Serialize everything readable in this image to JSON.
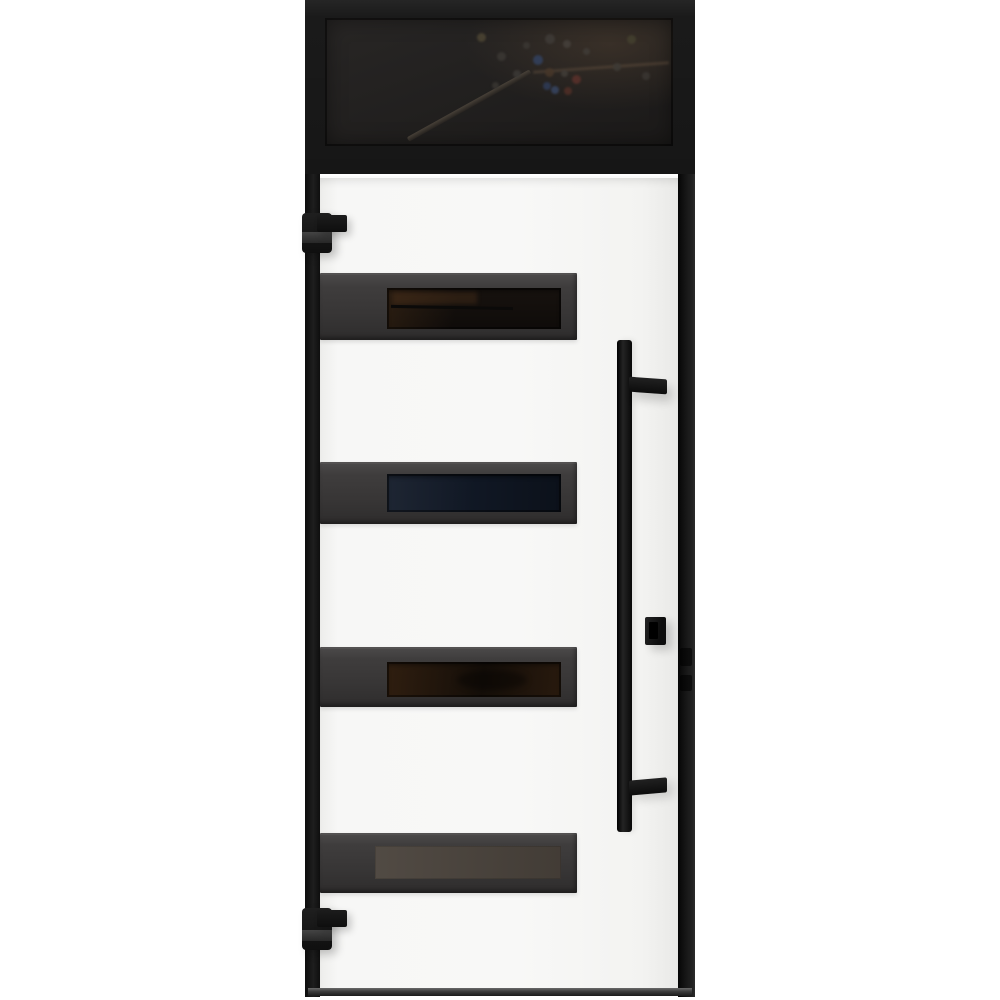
{
  "scene": {
    "subject": "Modern white front entry door with black metal frame, dark transom window above, four horizontal smoked-glass strips, long vertical black pull handle, lock cylinder and two black pivot hinges",
    "background": "#ffffff"
  },
  "palette": {
    "frame_black": "#1a1a1a",
    "door_white": "#f6f6f5",
    "strip_frame_gray": "#3b3939",
    "hardware_black": "#121212",
    "threshold_gray": "#3a3a3a"
  },
  "transom": {
    "glass_base": "#211f1e",
    "reflection_dots": [
      {
        "x": 152,
        "y": 15,
        "s": 9,
        "c": "#4a4332"
      },
      {
        "x": 198,
        "y": 24,
        "s": 7,
        "c": "#3a3632"
      },
      {
        "x": 220,
        "y": 16,
        "s": 10,
        "c": "#3e3a36"
      },
      {
        "x": 238,
        "y": 22,
        "s": 8,
        "c": "#443f3a"
      },
      {
        "x": 258,
        "y": 30,
        "s": 7,
        "c": "#3f3b36"
      },
      {
        "x": 172,
        "y": 34,
        "s": 9,
        "c": "#3a3733"
      },
      {
        "x": 208,
        "y": 37,
        "s": 10,
        "c": "#32405c"
      },
      {
        "x": 188,
        "y": 52,
        "s": 8,
        "c": "#3b3835"
      },
      {
        "x": 220,
        "y": 50,
        "s": 9,
        "c": "#463629"
      },
      {
        "x": 236,
        "y": 52,
        "s": 7,
        "c": "#403c37"
      },
      {
        "x": 247,
        "y": 57,
        "s": 9,
        "c": "#58302a"
      },
      {
        "x": 218,
        "y": 64,
        "s": 8,
        "c": "#2e3a54"
      },
      {
        "x": 226,
        "y": 68,
        "s": 8,
        "c": "#36435e"
      },
      {
        "x": 239,
        "y": 69,
        "s": 8,
        "c": "#4e2e26"
      },
      {
        "x": 167,
        "y": 64,
        "s": 7,
        "c": "#383531"
      },
      {
        "x": 302,
        "y": 17,
        "s": 9,
        "c": "#433f2e"
      },
      {
        "x": 288,
        "y": 45,
        "s": 8,
        "c": "#3d3a35"
      },
      {
        "x": 317,
        "y": 54,
        "s": 8,
        "c": "#393531"
      }
    ]
  },
  "door": {
    "glass_strips": [
      {
        "id": "strip-1",
        "tint": "#1b1511"
      },
      {
        "id": "strip-2",
        "tint": "#121a28"
      },
      {
        "id": "strip-3",
        "tint": "#1d140c"
      },
      {
        "id": "strip-4",
        "tint": "#4a433c"
      }
    ]
  }
}
